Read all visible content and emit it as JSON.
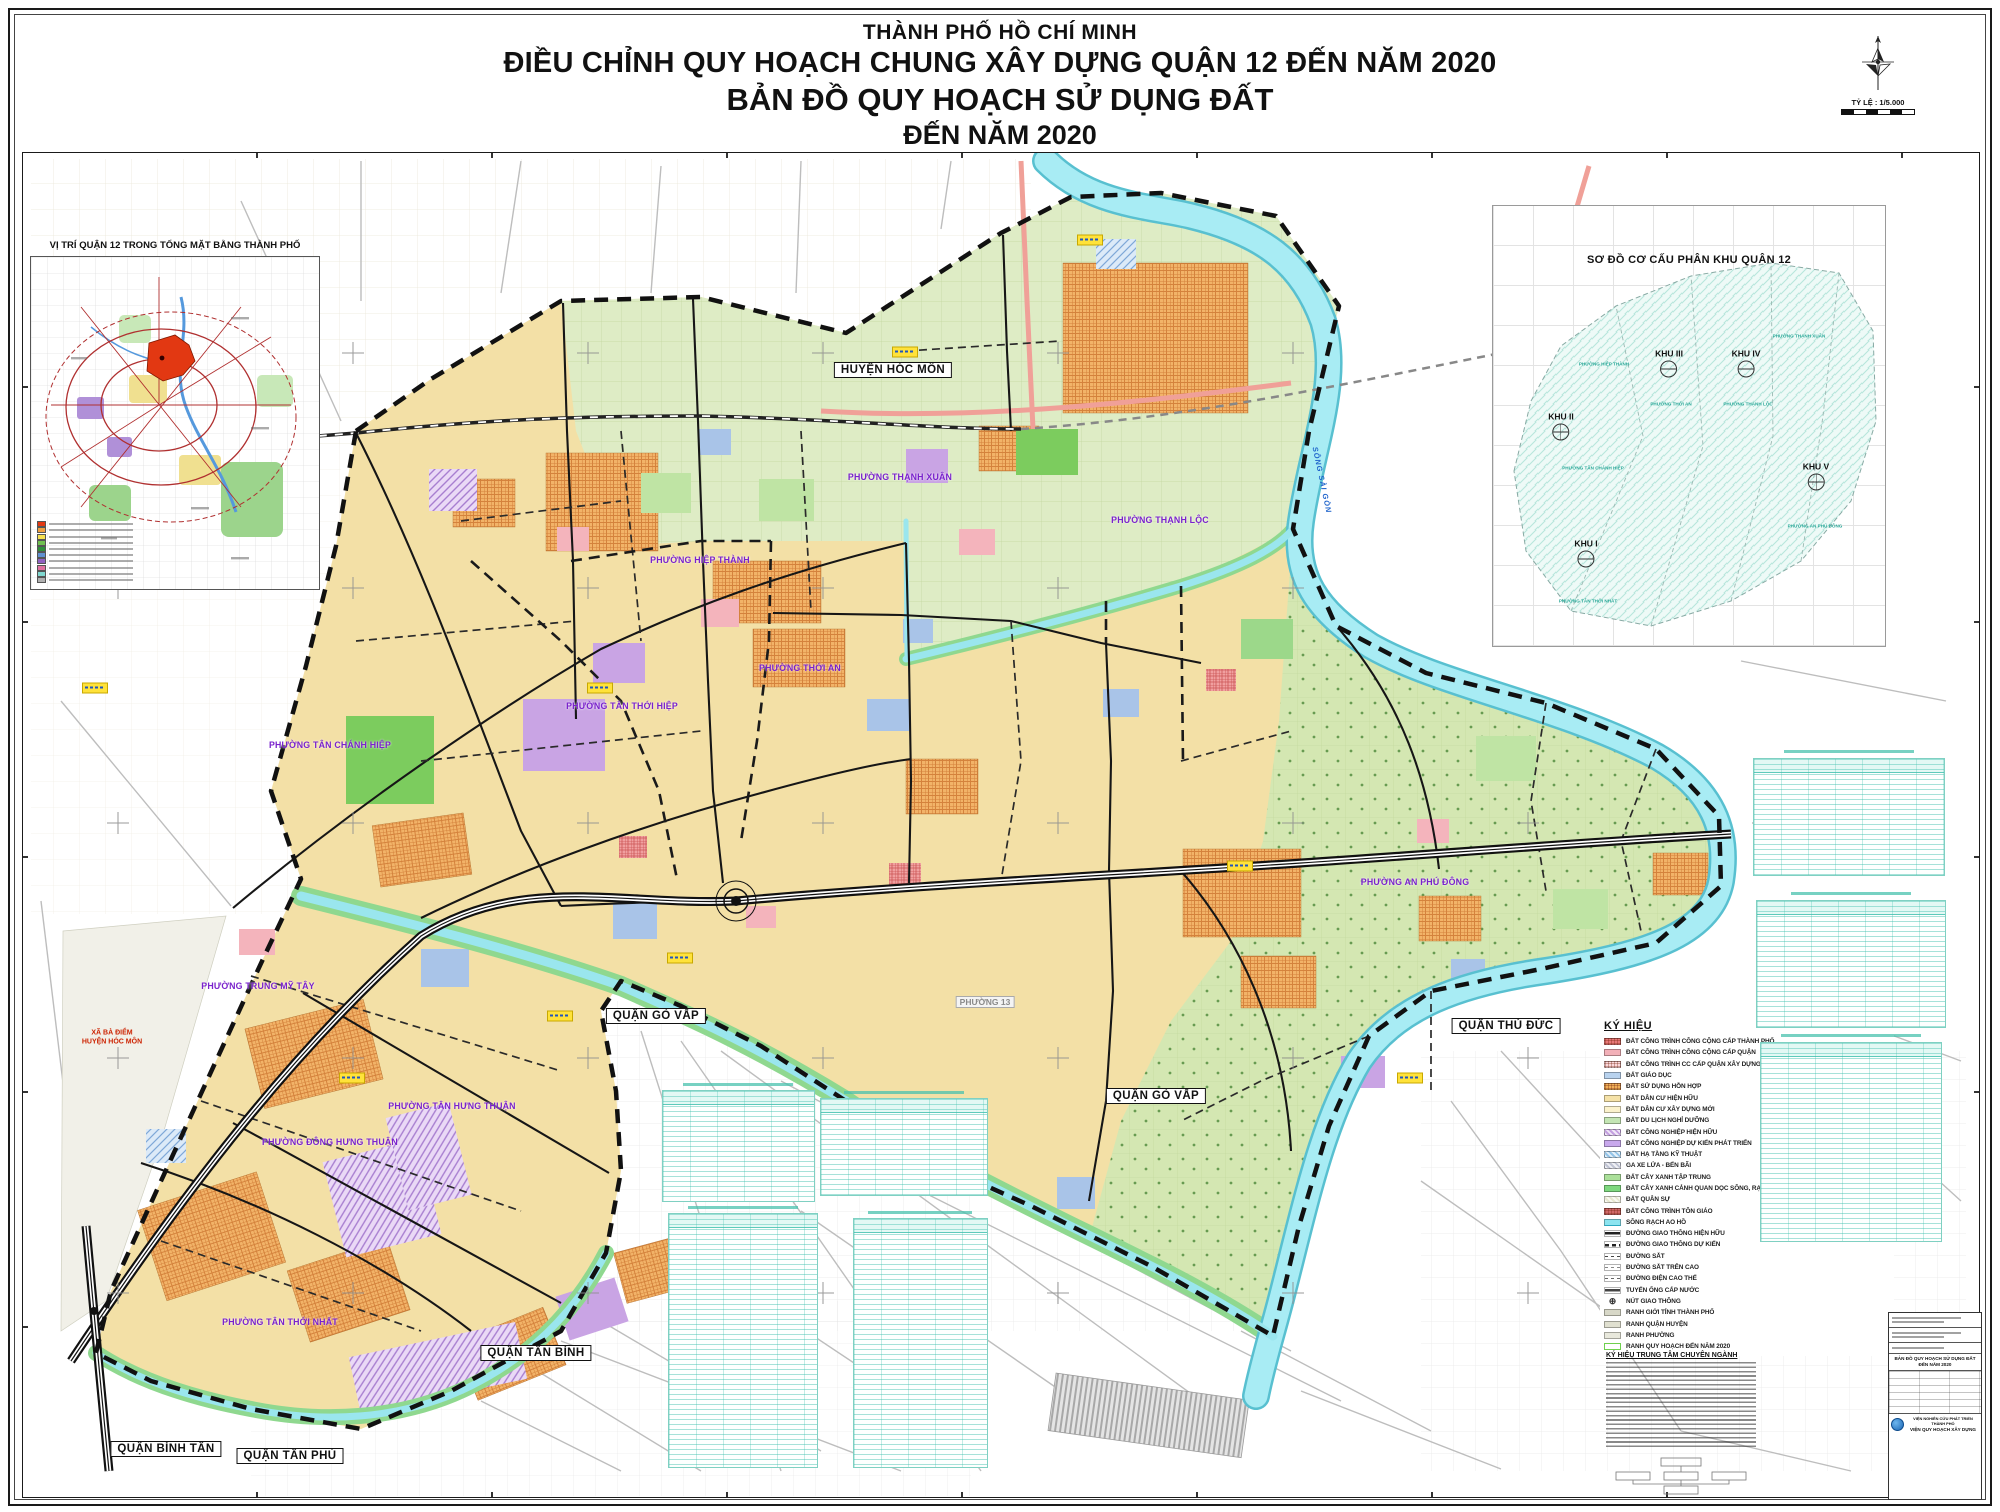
{
  "title": {
    "line1": "THÀNH PHỐ HỒ CHÍ MINH",
    "line2": "ĐIỀU CHỈNH QUY HOẠCH CHUNG XÂY DỰNG QUẬN 12 ĐẾN NĂM 2020",
    "line3": "BẢN ĐỒ QUY HOẠCH SỬ DỤNG ĐẤT",
    "line4": "ĐẾN NĂM 2020"
  },
  "scale": {
    "label": "TỶ LỆ : 1/5.000"
  },
  "inset_left": {
    "title": "VỊ TRÍ QUẬN 12 TRONG TỔNG MẶT BẰNG THÀNH PHỐ",
    "legend_colors": [
      "#e23812",
      "#f0a040",
      "#f5e050",
      "#70c050",
      "#2e8f3a",
      "#6090d0",
      "#9060c0",
      "#e070a0",
      "#80d8d0",
      "#b0b0b0"
    ]
  },
  "inset_right": {
    "title": "SƠ ĐỒ CƠ CẤU PHÂN KHU QUẬN 12",
    "zones": [
      {
        "name": "KHU I",
        "x": 93,
        "y": 347
      },
      {
        "name": "KHU II",
        "x": 68,
        "y": 220
      },
      {
        "name": "KHU III",
        "x": 176,
        "y": 157
      },
      {
        "name": "KHU IV",
        "x": 253,
        "y": 157
      },
      {
        "name": "KHU V",
        "x": 323,
        "y": 270
      }
    ],
    "wards": [
      {
        "text": "PHƯỜNG HIỆP THÀNH",
        "x": 111,
        "y": 158
      },
      {
        "text": "PHƯỜNG THỚI AN",
        "x": 178,
        "y": 198
      },
      {
        "text": "PHƯỜNG THẠNH LỘC",
        "x": 255,
        "y": 198
      },
      {
        "text": "PHƯỜNG THẠNH XUÂN",
        "x": 306,
        "y": 130
      },
      {
        "text": "PHƯỜNG TÂN CHÁNH HIỆP",
        "x": 100,
        "y": 262
      },
      {
        "text": "PHƯỜNG AN PHÚ ĐÔNG",
        "x": 322,
        "y": 320
      },
      {
        "text": "PHƯỜNG TÂN THỚI NHẤT",
        "x": 95,
        "y": 395
      }
    ]
  },
  "map": {
    "district_labels": [
      {
        "text": "HUYỆN HÓC MÔN",
        "x": 893,
        "y": 370
      },
      {
        "text": "QUẬN GÒ VẤP",
        "x": 656,
        "y": 1016
      },
      {
        "text": "QUẬN GÒ VẤP",
        "x": 1156,
        "y": 1096
      },
      {
        "text": "QUẬN THỦ ĐỨC",
        "x": 1506,
        "y": 1026
      },
      {
        "text": "QUẬN TÂN BÌNH",
        "x": 536,
        "y": 1353
      },
      {
        "text": "QUẬN BÌNH TÂN",
        "x": 166,
        "y": 1449
      },
      {
        "text": "QUẬN TÂN PHÚ",
        "x": 290,
        "y": 1456
      }
    ],
    "ward_labels": [
      {
        "text": "PHƯỜNG THẠNH XUÂN",
        "x": 900,
        "y": 477
      },
      {
        "text": "PHƯỜNG THẠNH LỘC",
        "x": 1160,
        "y": 520
      },
      {
        "text": "PHƯỜNG HIỆP THÀNH",
        "x": 700,
        "y": 560
      },
      {
        "text": "PHƯỜNG THỚI AN",
        "x": 800,
        "y": 668
      },
      {
        "text": "PHƯỜNG TÂN THỚI HIỆP",
        "x": 622,
        "y": 706
      },
      {
        "text": "PHƯỜNG TÂN CHÁNH HIỆP",
        "x": 330,
        "y": 745
      },
      {
        "text": "PHƯỜNG TRUNG MỸ TÂY",
        "x": 258,
        "y": 986
      },
      {
        "text": "PHƯỜNG TÂN HƯNG THUẬN",
        "x": 452,
        "y": 1106
      },
      {
        "text": "PHƯỜNG ĐÔNG HƯNG THUẬN",
        "x": 330,
        "y": 1142
      },
      {
        "text": "PHƯỜNG TÂN THỚI NHẤT",
        "x": 280,
        "y": 1322
      },
      {
        "text": "PHƯỜNG AN PHÚ ĐÔNG",
        "x": 1415,
        "y": 882
      }
    ],
    "context_labels": [
      {
        "text": "PHƯỜNG 13",
        "x": 985,
        "y": 1002
      }
    ],
    "special_label": {
      "line1": "XÃ BÀ ĐIỂM",
      "line2": "HUYỆN HÓC MÔN",
      "x": 112,
      "y": 1038
    },
    "river_label": {
      "text": "SÔNG SÀI GÒN",
      "x": 1322,
      "y": 480
    },
    "callouts": [
      {
        "x": 95,
        "y": 688
      },
      {
        "x": 600,
        "y": 688
      },
      {
        "x": 352,
        "y": 1078
      },
      {
        "x": 1090,
        "y": 240
      },
      {
        "x": 905,
        "y": 352
      },
      {
        "x": 1240,
        "y": 866
      },
      {
        "x": 560,
        "y": 1016
      },
      {
        "x": 1410,
        "y": 1078
      },
      {
        "x": 680,
        "y": 958
      }
    ]
  },
  "legend": {
    "title": "KÝ HIỆU",
    "items": [
      {
        "label": "ĐẤT CÔNG TRÌNH CÔNG CỘNG CẤP THÀNH PHỐ",
        "color": "#e87878",
        "kind": "check"
      },
      {
        "label": "ĐẤT CÔNG TRÌNH CÔNG CỘNG CẤP QUẬN",
        "color": "#f2b0b8",
        "kind": "solid"
      },
      {
        "label": "ĐẤT CÔNG TRÌNH CC CẤP QUẬN XÂY DỰNG MỚI",
        "color": "#fad8dc",
        "kind": "check"
      },
      {
        "label": "ĐẤT GIÁO DỤC",
        "color": "#b8d2ee",
        "kind": "solid"
      },
      {
        "label": "ĐẤT SỬ DỤNG HỖN HỢP",
        "color": "#f0b058",
        "kind": "check"
      },
      {
        "label": "ĐẤT DÂN CƯ HIỆN HỮU",
        "color": "#f5e2a8",
        "kind": "solid"
      },
      {
        "label": "ĐẤT DÂN CƯ XÂY DỰNG MỚI",
        "color": "#fbf2cc",
        "kind": "solid"
      },
      {
        "label": "ĐẤT DU LỊCH NGHỈ DƯỠNG",
        "color": "#c4e6b4",
        "kind": "solid"
      },
      {
        "label": "ĐẤT CÔNG NGHIỆP HIỆN HỮU",
        "color": "#c4a0e0",
        "kind": "hatch"
      },
      {
        "label": "ĐẤT CÔNG NGHIỆP DỰ KIẾN PHÁT TRIỂN",
        "color": "#c8a8ec",
        "kind": "solid"
      },
      {
        "label": "ĐẤT HẠ TẦNG KỸ THUẬT",
        "color": "#94c4e8",
        "kind": "hatch"
      },
      {
        "label": "GA XE LỬA - BẾN BÃI",
        "color": "#c0c4d4",
        "kind": "hatch"
      },
      {
        "label": "ĐẤT CÂY XANH TẬP TRUNG",
        "color": "#abe09a",
        "kind": "solid"
      },
      {
        "label": "ĐẤT CÂY XANH CẢNH QUAN DỌC SÔNG, RẠCH",
        "color": "#7fd87f",
        "kind": "solid"
      },
      {
        "label": "ĐẤT QUÂN SỰ",
        "color": "#e8e8d0",
        "kind": "hatch"
      },
      {
        "label": "ĐẤT CÔNG TRÌNH TÔN GIÁO",
        "color": "#d06868",
        "kind": "check"
      },
      {
        "label": "SÔNG RẠCH AO HỒ",
        "color": "#8ce4f0",
        "kind": "wave"
      },
      {
        "label": "ĐƯỜNG GIAO THÔNG HIỆN HỮU",
        "color": "#222222",
        "kind": "line"
      },
      {
        "label": "ĐƯỜNG GIAO THÔNG DỰ KIẾN",
        "color": "#222222",
        "kind": "dash"
      },
      {
        "label": "ĐƯỜNG SẮT",
        "color": "#444444",
        "kind": "dashthin"
      },
      {
        "label": "ĐƯỜNG SẮT TRÊN CAO",
        "color": "#888888",
        "kind": "dashthin"
      },
      {
        "label": "ĐƯỜNG ĐIỆN CAO THẾ",
        "color": "#666666",
        "kind": "dashthin"
      },
      {
        "label": "TUYẾN ỐNG CẤP NƯỚC",
        "color": "#444444",
        "kind": "line"
      },
      {
        "label": "NÚT GIAO THÔNG",
        "color": "#333333",
        "kind": "sym"
      },
      {
        "label": "RANH GIỚI TỈNH THÀNH PHỐ",
        "color": "#d8d8c8",
        "kind": "band"
      },
      {
        "label": "RANH QUẬN HUYỆN",
        "color": "#e0e0d0",
        "kind": "band"
      },
      {
        "label": "RANH PHƯỜNG",
        "color": "#e8e8dc",
        "kind": "band"
      },
      {
        "label": "RANH QUY HOẠCH ĐẾN NĂM 2020",
        "color": "#6fd04e",
        "kind": "outline"
      }
    ]
  },
  "legend2": {
    "title": "KÝ HIỆU TRUNG TÂM CHUYÊN NGÀNH"
  },
  "titleblock": {
    "map_title": "BẢN ĐỒ QUY HOẠCH SỬ DỤNG ĐẤT",
    "map_title2": "ĐẾN NĂM 2020",
    "org1": "VIỆN NGHIÊN CỨU PHÁT TRIỂN THÀNH PHỐ",
    "org2": "VIỆN QUY HOẠCH XÂY DỰNG"
  },
  "colors": {
    "residential": "#f3e0a6",
    "mixed_use": "#f2b368",
    "green": "#a8e098",
    "water": "#a8ecf4",
    "industry": "#c9a8e0",
    "ward_label": "#7a22cc",
    "table_ink": "#3bbfae",
    "road": "#1a1a1a"
  }
}
